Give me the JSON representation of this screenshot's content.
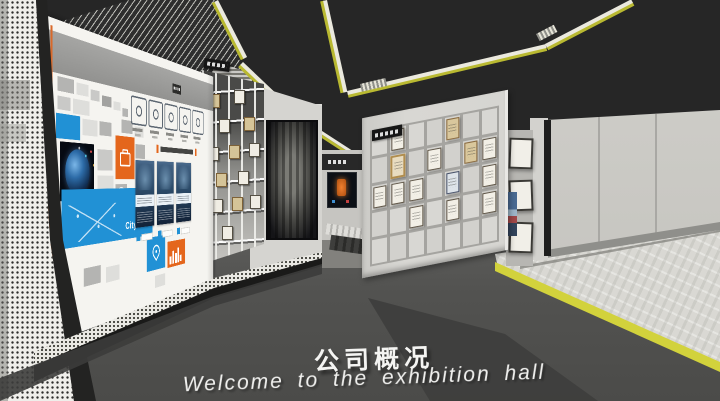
{
  "scene": {
    "floor_text": {
      "title": "公司概况",
      "subtitle": "Welcome to the exhibition hall"
    }
  },
  "palette": {
    "ceiling": "#262626",
    "floor_dark": "#4f4f4e",
    "floor_light": "#d9d8d3",
    "accent_yellow": "#b9b931",
    "accent_orange": "#e4661c",
    "accent_blue": "#2191d5",
    "wall_light": "#cdccc8",
    "board_white": "#f5f4f0"
  },
  "display_board": {
    "brand_text": "Citylast",
    "icons": [
      "award-icon",
      "handshake-icon",
      "bulb-icon",
      "chart-icon",
      "trophy-icon"
    ],
    "cards_count": 3,
    "tiles": [
      {
        "x": 18,
        "y": 58,
        "w": 26,
        "h": 15,
        "c": "g2"
      },
      {
        "x": 48,
        "y": 60,
        "w": 20,
        "h": 13,
        "c": "g3"
      },
      {
        "x": 72,
        "y": 64,
        "w": 16,
        "h": 12,
        "c": "g1"
      },
      {
        "x": 92,
        "y": 68,
        "w": 18,
        "h": 12,
        "c": "g4"
      },
      {
        "x": 114,
        "y": 72,
        "w": 14,
        "h": 10,
        "c": "g3"
      },
      {
        "x": 132,
        "y": 78,
        "w": 12,
        "h": 10,
        "c": "g2"
      },
      {
        "x": 18,
        "y": 78,
        "w": 20,
        "h": 14,
        "c": "g1"
      },
      {
        "x": 42,
        "y": 78,
        "w": 28,
        "h": 16,
        "c": "g3"
      },
      {
        "x": 130,
        "y": 92,
        "w": 24,
        "h": 16,
        "c": "g2"
      },
      {
        "x": 158,
        "y": 98,
        "w": 20,
        "h": 13,
        "c": "g3"
      },
      {
        "x": 16,
        "y": 96,
        "w": 38,
        "h": 26,
        "c": "blue"
      },
      {
        "x": 58,
        "y": 98,
        "w": 26,
        "h": 18,
        "c": "g3"
      },
      {
        "x": 88,
        "y": 98,
        "w": 22,
        "h": 16,
        "c": "g2"
      },
      {
        "x": 22,
        "y": 125,
        "w": 56,
        "h": 62,
        "c": "planet"
      },
      {
        "x": 84,
        "y": 130,
        "w": 28,
        "h": 24,
        "c": "g1"
      },
      {
        "x": 118,
        "y": 112,
        "w": 40,
        "h": 52,
        "c": "orange",
        "icon": "briefcase-icon"
      },
      {
        "x": 84,
        "y": 160,
        "w": 30,
        "h": 26,
        "c": "g3"
      },
      {
        "x": 118,
        "y": 170,
        "w": 24,
        "h": 22,
        "c": "g2",
        "icon": "globe-icon"
      },
      {
        "x": 160,
        "y": 120,
        "w": 22,
        "h": 18,
        "c": "g2"
      },
      {
        "x": 0,
        "y": 118,
        "w": 12,
        "h": 22,
        "c": "orange"
      },
      {
        "x": 0,
        "y": 190,
        "w": 14,
        "h": 24,
        "c": "orange"
      },
      {
        "x": 24,
        "y": 175,
        "w": 176,
        "h": 62,
        "c": "blue",
        "label": true
      },
      {
        "x": 186,
        "y": 240,
        "w": 46,
        "h": 44,
        "c": "blue",
        "icon": "map-pin-icon"
      },
      {
        "x": 232,
        "y": 185,
        "w": 22,
        "h": 20,
        "c": "orange"
      },
      {
        "x": 238,
        "y": 250,
        "w": 50,
        "h": 36,
        "c": "orange",
        "icon": "skyline-icon"
      },
      {
        "x": 60,
        "y": 262,
        "w": 30,
        "h": 20,
        "c": "g2"
      },
      {
        "x": 100,
        "y": 266,
        "w": 26,
        "h": 18,
        "c": "g3"
      },
      {
        "x": 0,
        "y": 258,
        "w": 14,
        "h": 26,
        "c": "orange"
      },
      {
        "x": 206,
        "y": 292,
        "w": 26,
        "h": 16,
        "c": "g3"
      }
    ]
  },
  "honor_wall": {
    "cols": 7,
    "rows": 5,
    "certificates": [
      {
        "col": 1,
        "row": 0,
        "style": "w"
      },
      {
        "col": 4,
        "row": 0,
        "style": "t"
      },
      {
        "col": 1,
        "row": 1,
        "style": "g"
      },
      {
        "col": 3,
        "row": 1,
        "style": "w"
      },
      {
        "col": 5,
        "row": 1,
        "style": "t"
      },
      {
        "col": 6,
        "row": 1,
        "style": "w"
      },
      {
        "col": 0,
        "row": 2,
        "style": "w"
      },
      {
        "col": 1,
        "row": 2,
        "style": "w"
      },
      {
        "col": 2,
        "row": 2,
        "style": "w"
      },
      {
        "col": 4,
        "row": 2,
        "style": "b"
      },
      {
        "col": 6,
        "row": 2,
        "style": "w"
      },
      {
        "col": 2,
        "row": 3,
        "style": "w"
      },
      {
        "col": 4,
        "row": 3,
        "style": "w"
      },
      {
        "col": 6,
        "row": 3,
        "style": "w"
      }
    ]
  },
  "shelf_wall": {
    "certificates": [
      {
        "x": 12,
        "y": 16,
        "style": "t"
      },
      {
        "x": 52,
        "y": 14,
        "style": "w"
      },
      {
        "x": 28,
        "y": 28,
        "style": "w"
      },
      {
        "x": 68,
        "y": 27,
        "style": "t"
      },
      {
        "x": 10,
        "y": 42,
        "style": "w"
      },
      {
        "x": 44,
        "y": 41,
        "style": "t"
      },
      {
        "x": 76,
        "y": 40,
        "style": "w"
      },
      {
        "x": 22,
        "y": 55,
        "style": "t"
      },
      {
        "x": 58,
        "y": 54,
        "style": "w"
      },
      {
        "x": 16,
        "y": 68,
        "style": "w"
      },
      {
        "x": 48,
        "y": 67,
        "style": "t"
      },
      {
        "x": 78,
        "y": 66,
        "style": "w"
      },
      {
        "x": 32,
        "y": 81,
        "style": "w"
      }
    ]
  },
  "side_panel": {
    "certificates_count": 3
  }
}
